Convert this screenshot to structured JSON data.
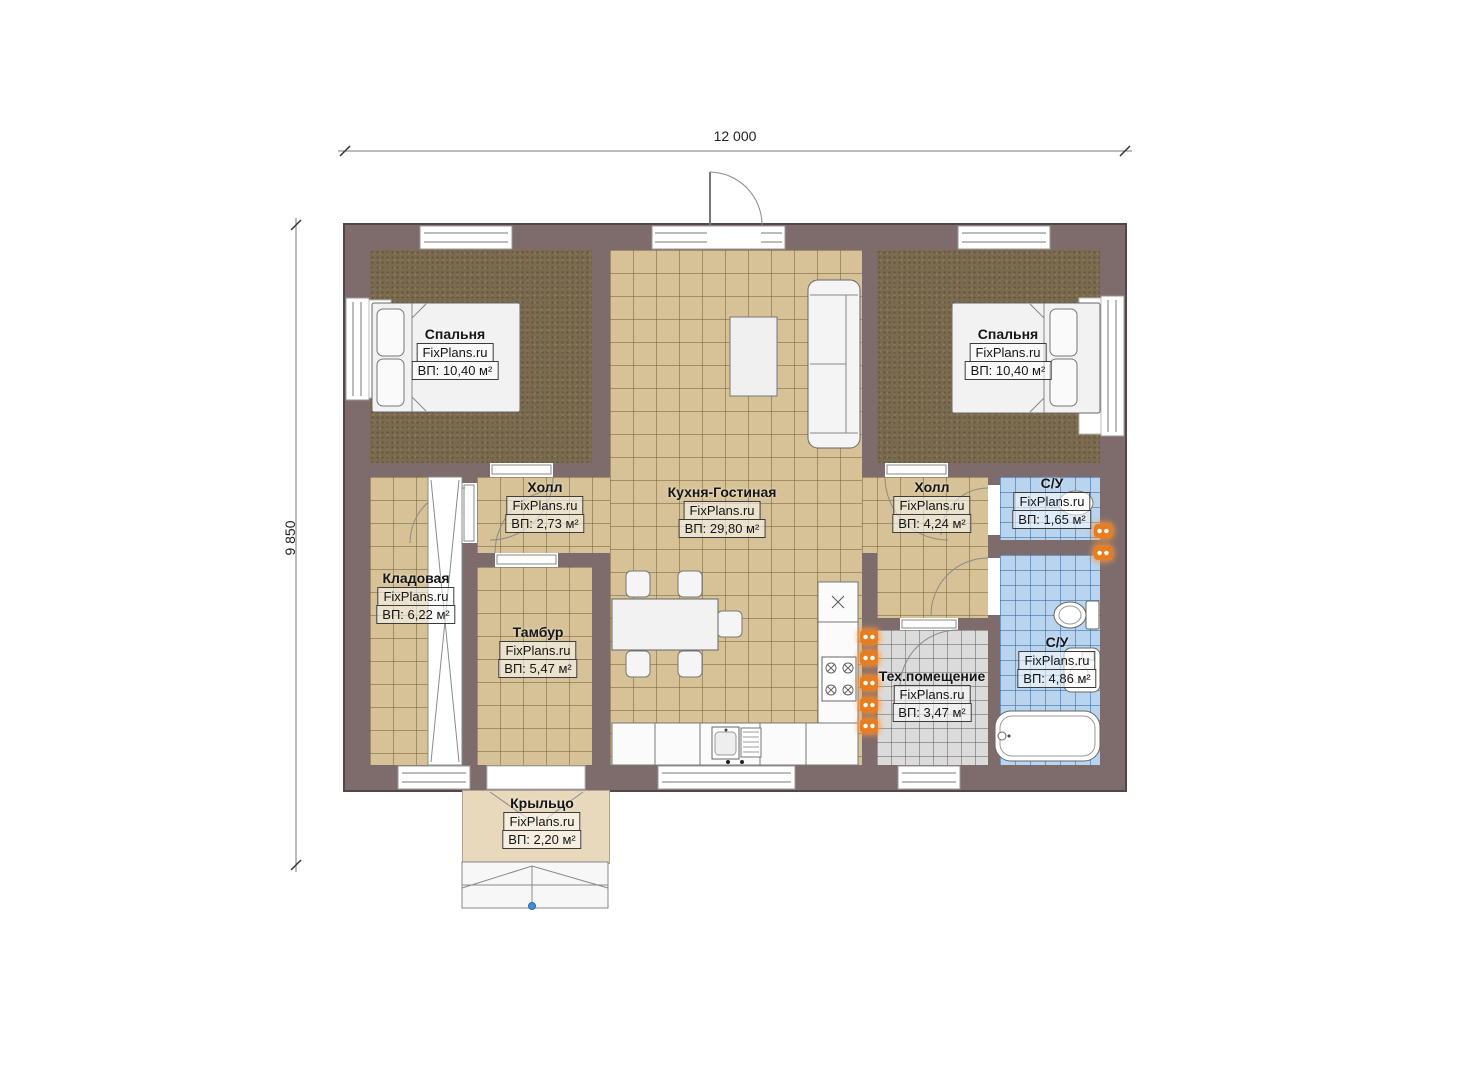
{
  "watermark": "FixPlans.ru",
  "dimensions": {
    "width": "12 000",
    "height": "9 850"
  },
  "rooms": [
    {
      "id": "bedroom-left",
      "name": "Спальня",
      "area": "ВП: 10,40 м²"
    },
    {
      "id": "bedroom-right",
      "name": "Спальня",
      "area": "ВП: 10,40 м²"
    },
    {
      "id": "kitchen-living",
      "name": "Кухня-Гостиная",
      "area": "ВП: 29,80 м²"
    },
    {
      "id": "hall-left",
      "name": "Холл",
      "area": "ВП: 2,73 м²"
    },
    {
      "id": "hall-right",
      "name": "Холл",
      "area": "ВП: 4,24 м²"
    },
    {
      "id": "su-top",
      "name": "С/У",
      "area": "ВП: 1,65 м²"
    },
    {
      "id": "su-bottom",
      "name": "С/У",
      "area": "ВП: 4,86 м²"
    },
    {
      "id": "storage",
      "name": "Кладовая",
      "area": "ВП: 6,22 м²"
    },
    {
      "id": "tambour",
      "name": "Тамбур",
      "area": "ВП: 5,47 м²"
    },
    {
      "id": "tech",
      "name": "Тех.помещение",
      "area": "ВП: 3,47 м²"
    },
    {
      "id": "porch",
      "name": "Крыльцо",
      "area": "ВП: 2,20 м²"
    }
  ],
  "colors": {
    "wall": "#7e6c6c",
    "floor_tile": "#d6c296",
    "bedroom_carpet": "#7b6a4e",
    "bathroom_tile": "#b9d4ef",
    "tech_tile": "#dbdbdb",
    "radiator": "#e87d1f",
    "porch_marker": "#3f8fd4"
  }
}
